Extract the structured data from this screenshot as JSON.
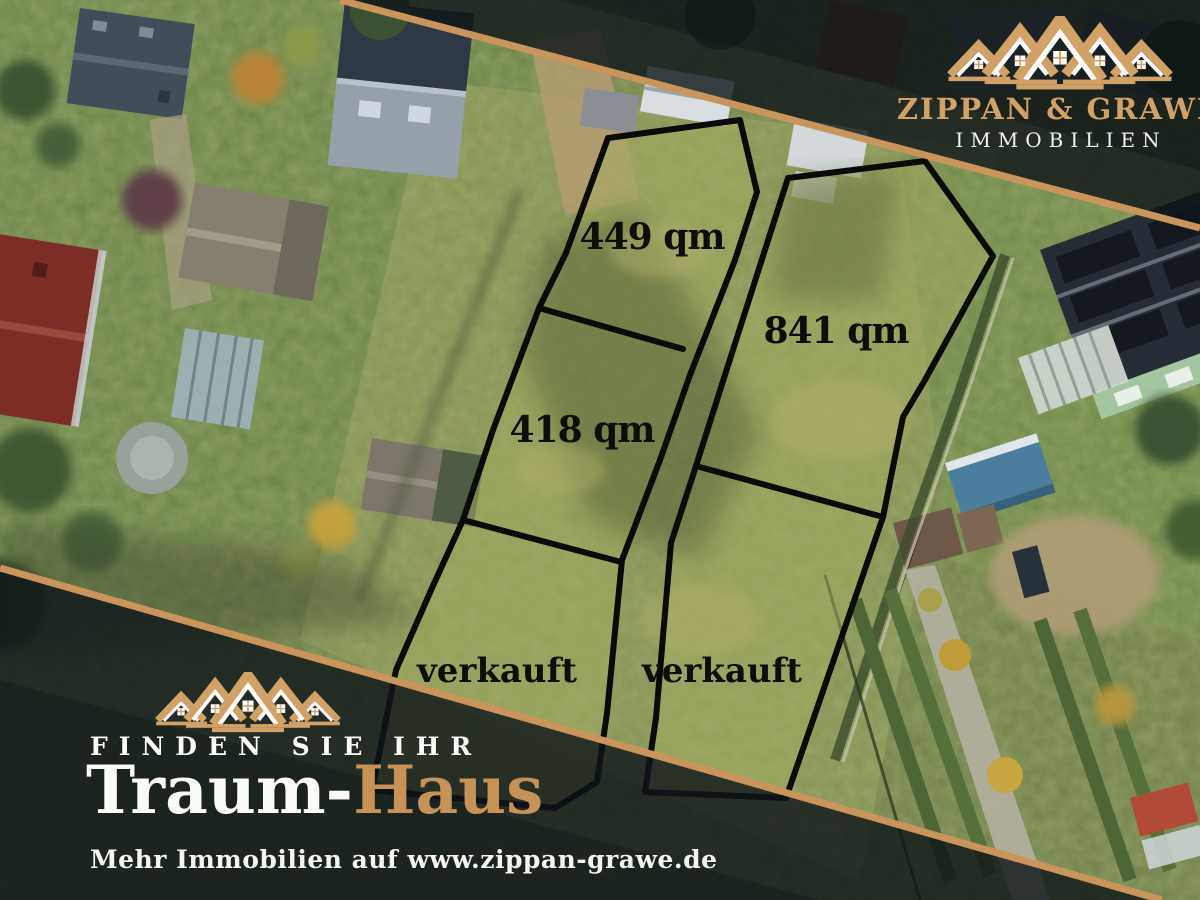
{
  "branding": {
    "company_line1": "ZIPPAN & GRAWE",
    "company_line2": "IMMOBILIEN"
  },
  "plots": [
    {
      "id": "plot-449",
      "label": "449 qm",
      "status": "available"
    },
    {
      "id": "plot-841",
      "label": "841 qm",
      "status": "available"
    },
    {
      "id": "plot-418",
      "label": "418 qm",
      "status": "available"
    },
    {
      "id": "plot-sold-left",
      "label": "verkauft",
      "status": "sold"
    },
    {
      "id": "plot-sold-right",
      "label": "verkauft",
      "status": "sold"
    }
  ],
  "tagline": {
    "line1": "FINDEN SIE IHR",
    "line2_white": "Traum-",
    "line2_gold": "Haus"
  },
  "footer": {
    "more_text": "Mehr Immobilien auf www.zippan-grawe.de"
  },
  "colors": {
    "gold": "#c9955a",
    "logo_gold": "#d2a165",
    "overlay_dark": "#0c1418",
    "plot_line": "#0a0a0a"
  }
}
